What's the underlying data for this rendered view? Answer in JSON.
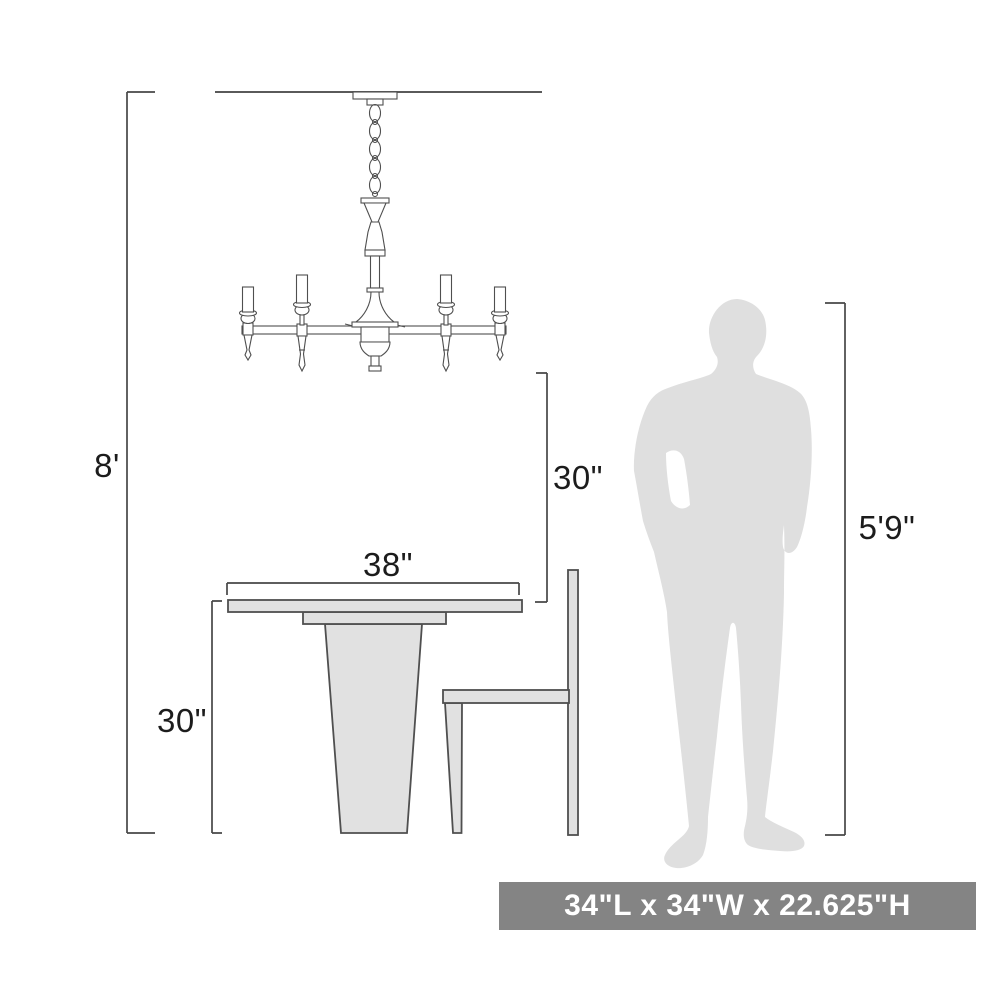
{
  "diagram": {
    "labels": {
      "ceiling_height": "8'",
      "hang_height": "30\"",
      "table_width": "38\"",
      "table_height": "30\"",
      "person_height": "5'9\""
    },
    "size_banner": {
      "text": "34\"L x 34\"W x 22.625\"H"
    },
    "figures": [
      {
        "name": "chandelier-drawing",
        "description": "6-arm candle chandelier hanging from ceiling by chain"
      },
      {
        "name": "dining-table-drawing",
        "description": "pedestal dining table, side view"
      },
      {
        "name": "chair-drawing",
        "description": "side chair, side view"
      },
      {
        "name": "person-silhouette",
        "description": "standing man silhouette for scale"
      }
    ],
    "colors": {
      "line": "#4f4f4f",
      "dim": "#474747",
      "furniture_fill": "#e1e1e1",
      "person_fill": "#dfdfdf",
      "text": "#1c1c1c",
      "banner_bg": "#848484",
      "banner_fg": "#ffffff"
    }
  }
}
